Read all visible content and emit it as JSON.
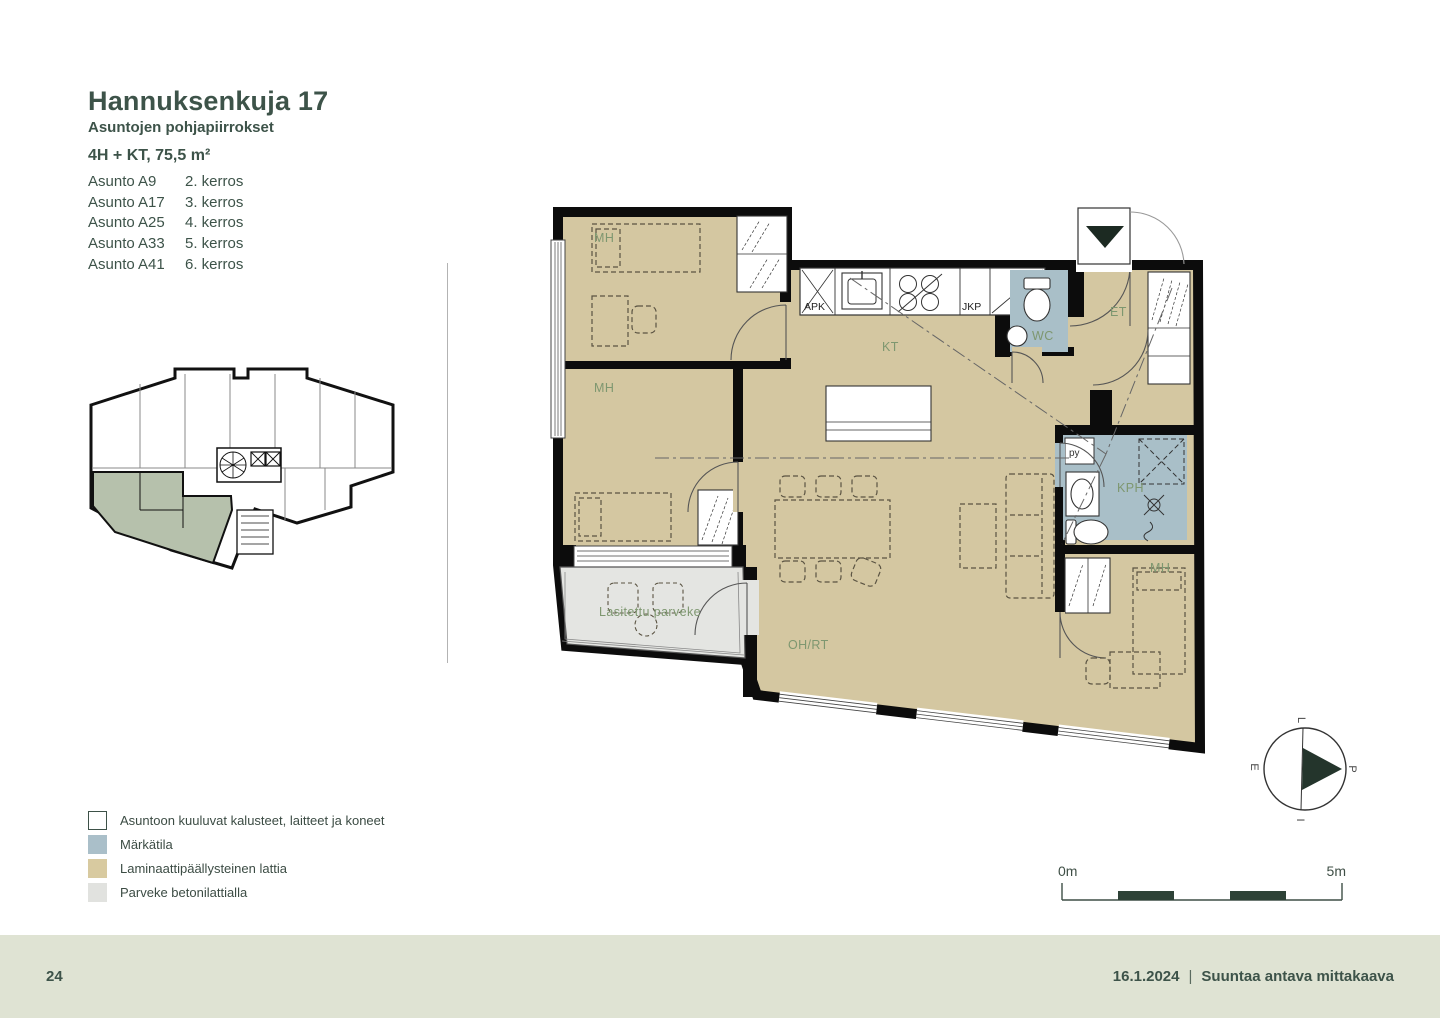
{
  "page": {
    "title": "Hannuksenkuja 17",
    "subtitle": "Asuntojen pohjapiirrokset",
    "apartment_type": "4H + KT, 75,5 m²"
  },
  "apartments": [
    {
      "name": "Asunto A9",
      "floor": "2. kerros"
    },
    {
      "name": "Asunto A17",
      "floor": "3. kerros"
    },
    {
      "name": "Asunto A25",
      "floor": "4. kerros"
    },
    {
      "name": "Asunto A33",
      "floor": "5. kerros"
    },
    {
      "name": "Asunto A41",
      "floor": "6. kerros"
    }
  ],
  "plan": {
    "rooms": {
      "mh1": "MH",
      "mh2": "MH",
      "mh3": "MH",
      "kt": "KT",
      "wc": "WC",
      "et": "ET",
      "kph": "KPH",
      "ohrt": "OH/RT",
      "apk": "APK",
      "jkp": "JKP",
      "py": "py",
      "balcony": "Lasitettu parveke"
    }
  },
  "legend": {
    "items": [
      {
        "label": "Asuntoon kuuluvat kalusteet, laitteet ja koneet",
        "color": "#ffffff"
      },
      {
        "label": "Märkätila",
        "color": "#aabfc9"
      },
      {
        "label": "Laminaattipäällysteinen lattia",
        "color": "#d8caa0"
      },
      {
        "label": "Parveke betonilattialla",
        "color": "#e1e2df"
      }
    ]
  },
  "scalebar": {
    "start": "0m",
    "end": "5m"
  },
  "compass": {
    "north": "P",
    "west": "L",
    "south": "E",
    "east": "I"
  },
  "footer": {
    "page_number": "24",
    "date": "16.1.2024",
    "separator": "|",
    "note": "Suuntaa antava mittakaava"
  },
  "colors": {
    "text_dark_green": "#3d5349",
    "room_label_green": "#7e9770",
    "floor_laminate": "#d4c7a1",
    "wet_room": "#a9bfc8",
    "balcony": "#e3e4e1",
    "footer_bg": "#dfe3d3",
    "scalebar_dark": "#2e4237",
    "overview_highlight": "#b6c1ac",
    "wall_black": "#0c0c0c"
  }
}
